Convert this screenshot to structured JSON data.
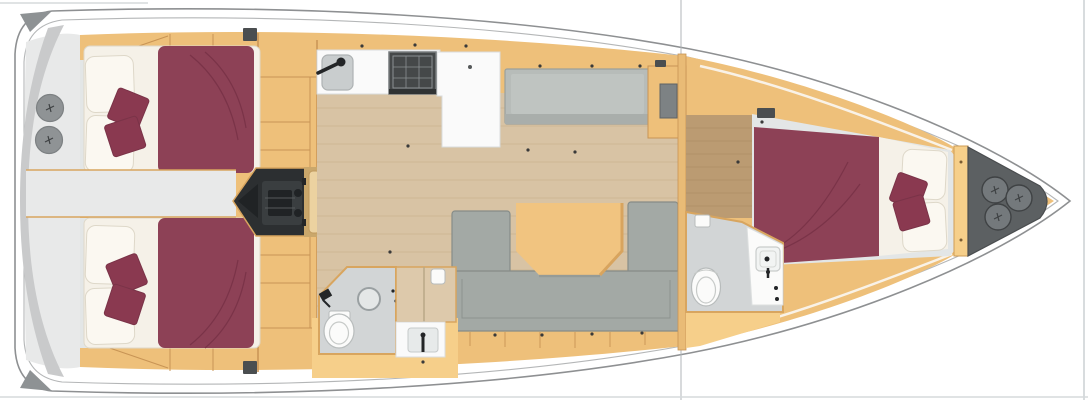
{
  "meta": {
    "description": "Sailing yacht interior floor plan, top-down 3D render",
    "view": "plan view, bow to the right, stern to the left"
  },
  "features": {
    "aft_cabins": 2,
    "forward_cabins": 1,
    "heads": 2,
    "stern_deck_hatches": 2,
    "bow_anchor_hatches": 3,
    "companionway_steps": 6
  },
  "palette": {
    "hull_fill": "#ffffff",
    "hull_stroke": "#8e9092",
    "hull_inner": "#b4b6b7",
    "deck_shadow": "#c9cacb",
    "stern_floor": "#e8e9e9",
    "corner_wedge": "#8e9294",
    "tan": "#eec07a",
    "tan_bright": "#f6cf8a",
    "tan_dark": "#c89455",
    "tan_wall": "#d8a55f",
    "wood": "#d8c3a4",
    "wood_line": "#c4ab87",
    "fwd_wood": "#bb9b72",
    "fwd_wood_line": "#a8885f",
    "cabin_floor": "#e3e6e6",
    "bed_white": "#f5f1e8",
    "pillow": "#fbf8f1",
    "pillow_line": "#ded8c9",
    "maroon": "#8d4156",
    "maroon_line": "#7a3348",
    "cushion": "#8a3950",
    "sofa": "#a3a9a5",
    "sofa_line": "#868c88",
    "bench": "#b7bcb9",
    "bench_line": "#9aa09c",
    "bench_face": "#a9aeab",
    "table": "#f1c480",
    "table_edge": "#d8a45e",
    "engine": "#2c2f31",
    "engine_panel": "#3a3e40",
    "engine_core": "#202325",
    "stairs_base": "#caa76b",
    "stair": "#ecd2a0",
    "stair_line": "#c09a5e",
    "stove": "#454849",
    "stove_frame": "#767a7c",
    "stove_line": "#8b9092",
    "sink": "#c9cdce",
    "counter": "#fafafa",
    "counter_line": "#d9dcdd",
    "head_floor": "#d2d5d6",
    "fixture": "#fbfbfa",
    "fixture_line": "#b8bcbc",
    "locker": "#5c6062",
    "locker_line": "#4a4d4f",
    "hatch": "#74797c",
    "hatch_line": "#3f4244",
    "stern_hatch": "#8f9395",
    "stern_hatch_line": "#7d8183",
    "mast": "#b0b5b8",
    "divider": "#ccd0d3",
    "frame": "#d6dadc",
    "dot": "#3a3a3a",
    "black": "#232527",
    "vent": "#4a4e50"
  }
}
